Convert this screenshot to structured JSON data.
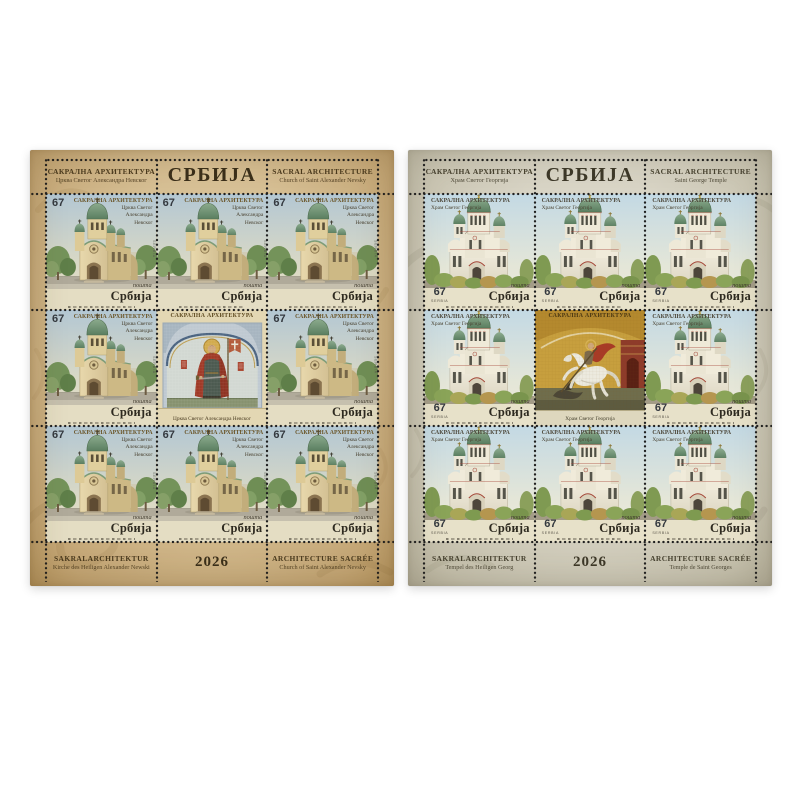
{
  "artwork": {
    "type": "two postage stamp miniature sheets on white background",
    "background": "#ffffff",
    "colors": {
      "dome_green": "#6f9372",
      "accent_red": "#a5483a",
      "mosaic_gold": "#c79f3e",
      "perforation": "#1f1f1f"
    }
  },
  "sheets": [
    {
      "name": "Church of Saint Alexander Nevsky miniature sheet",
      "palette": {
        "base": "#d6bf94",
        "edge": "#b5955f",
        "text": "#4a3a1e",
        "country": "#3a2f1a"
      },
      "header": {
        "left_title": "САКРАЛНА АРХИТЕКТУРА",
        "left_subtitle": "Црква Светог Александра Невског",
        "country": "СРБИЈА",
        "right_title": "SACRAL ARCHITECTURE",
        "right_subtitle": "Church of Saint Alexander Nevsky"
      },
      "footer": {
        "left_title": "SAKRALARCHITEKTUR",
        "left_subtitle": "Kirche des Heiligen Alexander Newski",
        "year": "2026",
        "right_title": "ARCHITECTURE SACRÉE",
        "right_subtitle": "Church of Saint Alexander Nevsky"
      },
      "stamp": {
        "denomination": "67",
        "series_title": "САКРАЛНА АРХИТЕКТУРА",
        "subject_line_1": "Црква Светог",
        "subject_line_2": "Александра",
        "subject_line_3": "Невског",
        "post_label": "пошта",
        "country_name": "Србија",
        "country_latin": "SERBIA"
      },
      "vignette": {
        "top_title": "САКРАЛНА АРХИТЕКТУРА",
        "caption": "Црква Светог Александра Невског"
      }
    },
    {
      "name": "Saint George Temple miniature sheet",
      "palette": {
        "base": "#d8d4c5",
        "edge": "#b7b19b",
        "text": "#46412f",
        "country": "#3d3828"
      },
      "header": {
        "left_title": "САКРАЛНА АРХИТЕКТУРА",
        "left_subtitle": "Храм Светог Георгија",
        "country": "СРБИЈА",
        "right_title": "SACRAL ARCHITECTURE",
        "right_subtitle": "Saint George Temple"
      },
      "footer": {
        "left_title": "SAKRALARCHITEKTUR",
        "left_subtitle": "Tempel des Heiligen Georg",
        "year": "2026",
        "right_title": "ARCHITECTURE SACRÉE",
        "right_subtitle": "Temple de Saint Georges"
      },
      "stamp": {
        "denomination": "67",
        "series_title": "САКРАЛНА АРХИТЕКТУРА",
        "subject_line_1": "Храм Светог Георгија",
        "post_label": "пошта",
        "country_name": "Србија",
        "country_latin": "SERBIA"
      },
      "vignette": {
        "top_title": "САКРАЛНА АРХИТЕКТУРА",
        "caption": "Храм Светог Георгија"
      }
    }
  ]
}
